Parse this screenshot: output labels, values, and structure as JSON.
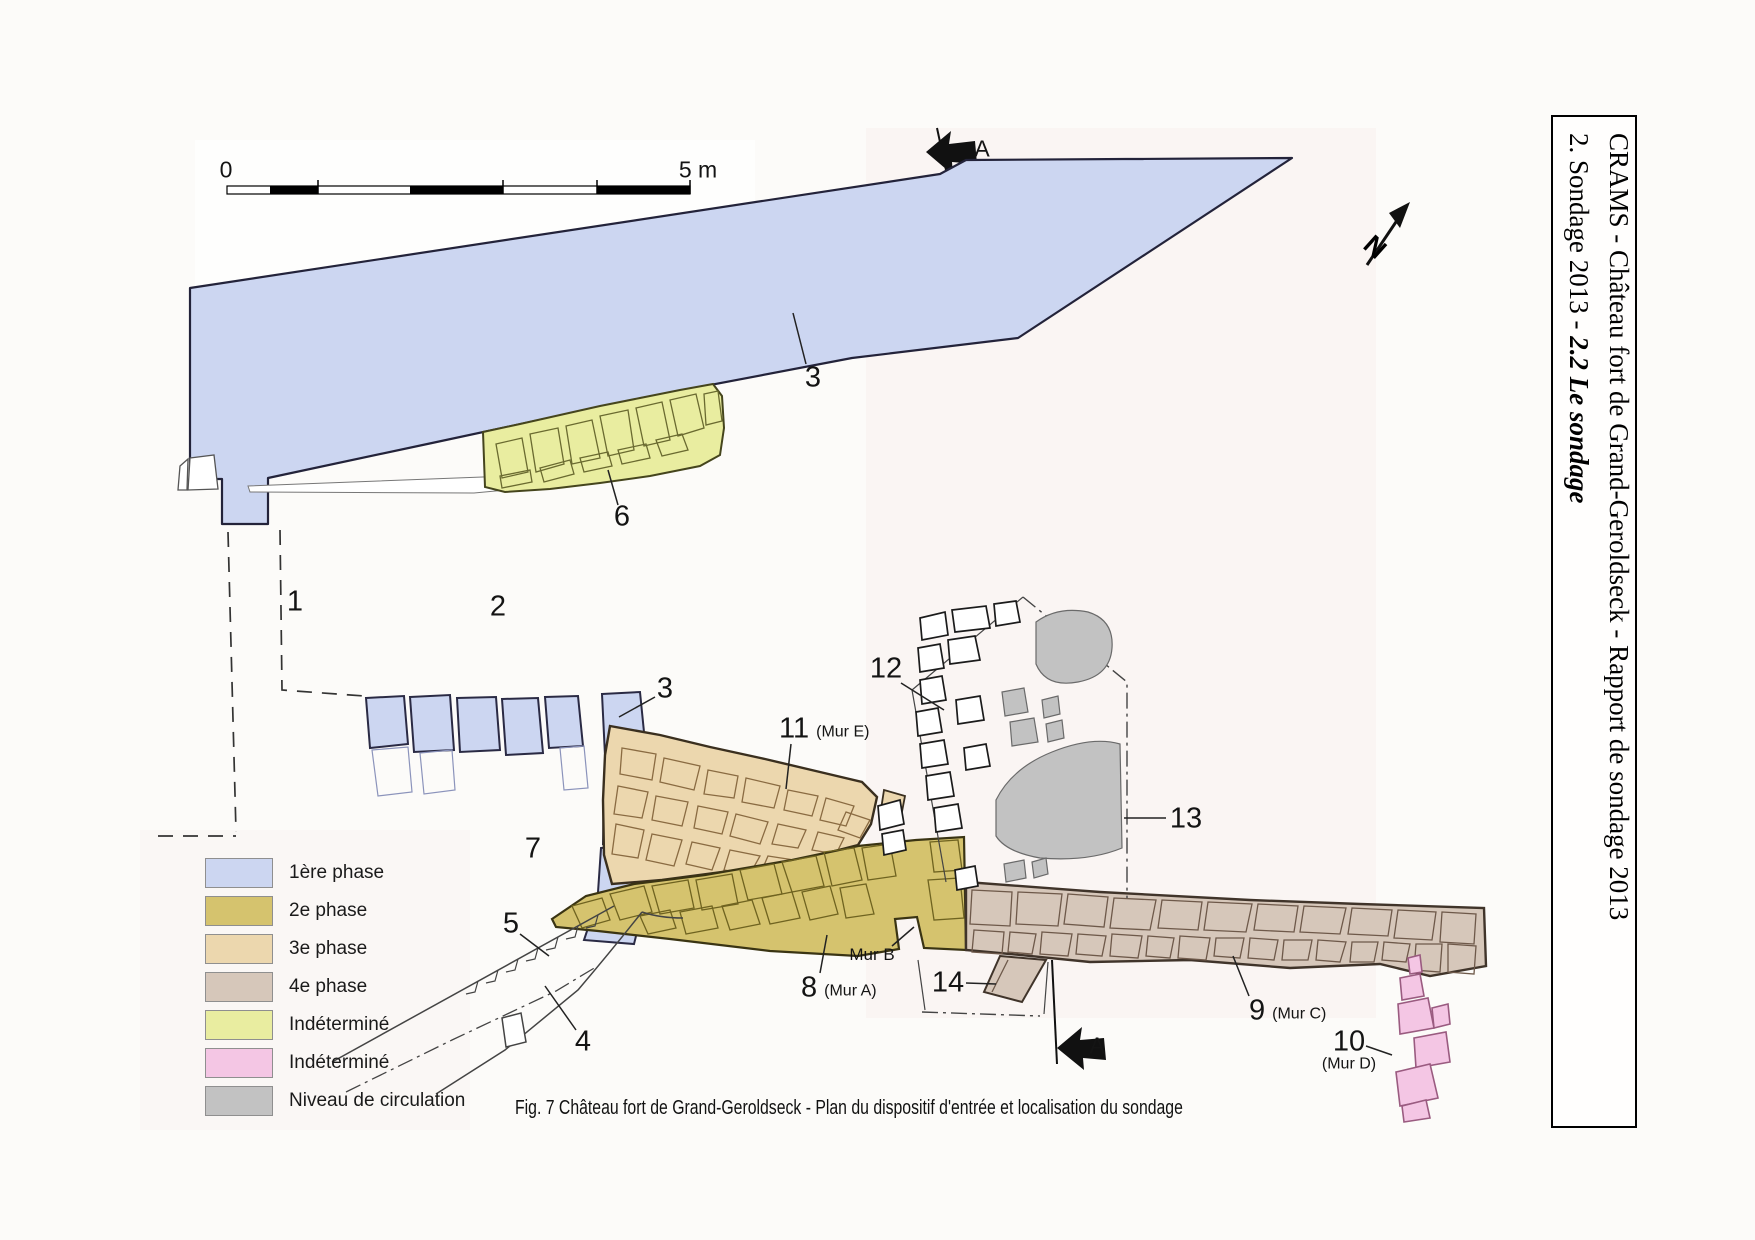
{
  "colors": {
    "phase1_blue": "#ccd6f1",
    "phase2_olive": "#d5c36e",
    "phase3_tan": "#ecd7ae",
    "phase4_brown": "#d6c7ba",
    "indetermine_yellow": "#e9eda0",
    "indetermine_pink": "#f4c6e4",
    "circulation_gray": "#c2c2c2"
  },
  "report_header": {
    "line1": "CRAMS - Château fort de Grand-Geroldseck - Rapport de sondage 2013",
    "line2_prefix": "2. Sondage 2013  -  ",
    "line2_emphasis": "2.2 Le sondage"
  },
  "scale_bar": {
    "zero_label": "0",
    "max_label": "5 m"
  },
  "compass": {
    "letter": "N"
  },
  "section_line": {
    "top_label": "A",
    "bottom_label": "A"
  },
  "labels": {
    "n1": "1",
    "n2": "2",
    "n3_upper": "3",
    "n3_lower": "3",
    "n4": "4",
    "n5": "5",
    "n6": "6",
    "n7": "7",
    "n8": "8",
    "n8_sub": "(Mur A)",
    "n9": "9",
    "n9_sub": "(Mur C)",
    "n10": "10",
    "n10_sub": "(Mur D)",
    "n11": "11",
    "n11_sub": "(Mur E)",
    "n12": "12",
    "n13": "13",
    "n14": "14",
    "mur_b": "Mur B"
  },
  "legend": {
    "items": [
      {
        "label": "1ère phase",
        "color": "#ccd6f1"
      },
      {
        "label": "2e phase",
        "color": "#d5c36e"
      },
      {
        "label": "3e phase",
        "color": "#ecd7ae"
      },
      {
        "label": "4e phase",
        "color": "#d6c7ba"
      },
      {
        "label": "Indéterminé",
        "color": "#e9eda0"
      },
      {
        "label": "Indéterminé",
        "color": "#f4c6e4"
      },
      {
        "label": "Niveau de circulation",
        "color": "#c2c2c2"
      }
    ]
  },
  "caption": "Fig. 7 Château fort de Grand-Geroldseck - Plan du dispositif d'entrée et localisation du sondage"
}
